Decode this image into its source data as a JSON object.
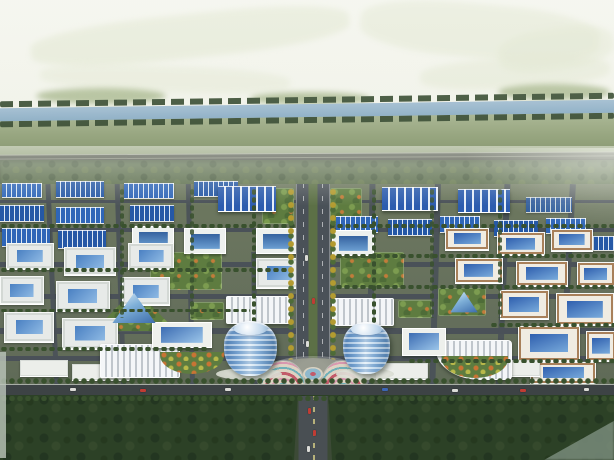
{
  "scene": {
    "type": "aerial-architectural-rendering",
    "subject": "bird's-eye rendering of an industrial park: river and fields behind, grid of blue-roofed factories and courtyard buildings, central tree-lined boulevard with twin cylindrical glass towers and a circular flower plaza, dark forest belt in front"
  },
  "palette": {
    "sky_top": "#f4f5ee",
    "sky_bottom": "#e8ecdc",
    "distant_field": "#dfe5cd",
    "mound": "#9cae7e",
    "river": "#a3bed1",
    "river_tree": "#43563c",
    "field_top": "#aab794",
    "field_bottom": "#84946c",
    "highway": "#42473d",
    "highway_line": "#767b6c",
    "treeline": "#5c6e4e",
    "treeline_dark": "#4a5c40",
    "park": "#68725e",
    "road": "#4a5158",
    "road_main": "#3d4345",
    "roof_a": "#2f66b8",
    "roof_b": "#2558a6",
    "big_roof": "#2c5cae",
    "rib": "#dce8f4",
    "wall": "#edf0ee",
    "court_blue_1": "#4a80c2",
    "court_blue_2": "#8fbae4",
    "tan": "#a8805a",
    "tan_wall": "#f0ece2",
    "lawn": "#5e7c40",
    "lawn_light": "#7c9c50",
    "tree_dark": "#39512e",
    "tree_mid": "#4e6c38",
    "tree_yellow": "#b39b30",
    "tower_2": "#d8e9f5",
    "tower_3": "#4d7cb0",
    "plaza": "#8e9188",
    "fan_base": "#ddd2c2",
    "flower_red": "#c25a6a",
    "flower_teal": "#6fb0b8",
    "flower_pink": "#d898b0",
    "forest": "#2c4126",
    "forest_dark": "#233621",
    "forest_light": "#7a8c7c",
    "car_red": "#c03c34",
    "car_white": "#dcdcd8",
    "car_blue": "#3c66b4"
  },
  "scene_items": {
    "distant_fields": [
      {
        "x": 30,
        "y": 14,
        "w": 320,
        "h": 44,
        "r": -6,
        "o": 0.55
      },
      {
        "x": 360,
        "y": 4,
        "w": 240,
        "h": 54,
        "r": 5,
        "o": 0.5
      },
      {
        "x": 420,
        "y": 58,
        "w": 190,
        "h": 30,
        "r": -3,
        "o": 0.45
      },
      {
        "x": 40,
        "y": 66,
        "w": 250,
        "h": 26,
        "r": 2,
        "o": 0.4
      },
      {
        "x": 498,
        "y": 28,
        "w": 116,
        "h": 42,
        "r": -8,
        "o": 0.45
      }
    ],
    "mounds": [
      {
        "x": 36,
        "y": 88,
        "w": 130,
        "h": 16
      },
      {
        "x": 250,
        "y": 92,
        "w": 120,
        "h": 13
      },
      {
        "x": 498,
        "y": 84,
        "w": 112,
        "h": 16
      }
    ],
    "fields": [
      {
        "x": 0,
        "y": 112,
        "w": 614,
        "h": 48
      }
    ],
    "river_trees": [
      {
        "x": 0,
        "y": 97,
        "w": 614,
        "h": 6,
        "r": -0.8
      },
      {
        "x": 0,
        "y": 117,
        "w": 614,
        "h": 6,
        "r": -0.8
      }
    ],
    "rivers": [
      {
        "x": -8,
        "y": 104,
        "w": 630,
        "h": 13,
        "r": -0.8
      }
    ],
    "highways": [
      {
        "x": 0,
        "y": 154,
        "w": 614,
        "h": 7,
        "r": -0.3
      }
    ],
    "treelines": [
      {
        "x": 0,
        "y": 160,
        "w": 614,
        "h": 26
      }
    ],
    "parks": [
      {
        "x": 0,
        "y": 184,
        "w": 614,
        "h": 212
      }
    ],
    "h_roads": [
      {
        "x": 0,
        "y": 200,
        "w": 614,
        "h": 3
      },
      {
        "x": 0,
        "y": 228,
        "w": 614,
        "h": 4
      },
      {
        "x": 0,
        "y": 262,
        "w": 614,
        "h": 5
      },
      {
        "x": 0,
        "y": 294,
        "w": 614,
        "h": 5
      },
      {
        "x": 0,
        "y": 328,
        "w": 614,
        "h": 6
      },
      {
        "x": 0,
        "y": 356,
        "w": 614,
        "h": 5
      }
    ],
    "v_roads": [
      {
        "x": 50,
        "y": 184,
        "w": 5,
        "h": 210,
        "r": -2.5
      },
      {
        "x": 118,
        "y": 184,
        "w": 5,
        "h": 210,
        "r": -1.8
      },
      {
        "x": 188,
        "y": 184,
        "w": 5,
        "h": 210,
        "r": -1.2
      },
      {
        "x": 252,
        "y": 252,
        "w": 5,
        "h": 144,
        "r": -0.6
      },
      {
        "x": 368,
        "y": 184,
        "w": 6,
        "h": 212,
        "r": 0.8
      },
      {
        "x": 432,
        "y": 184,
        "w": 6,
        "h": 212,
        "r": 1.6
      },
      {
        "x": 500,
        "y": 184,
        "w": 6,
        "h": 212,
        "r": 2.4
      },
      {
        "x": 564,
        "y": 184,
        "w": 6,
        "h": 212,
        "r": 3.2
      }
    ],
    "plots": [
      {
        "x": 150,
        "y": 252,
        "w": 72,
        "h": 38
      },
      {
        "x": 340,
        "y": 252,
        "w": 64,
        "h": 36
      },
      {
        "x": 262,
        "y": 188,
        "w": 32,
        "h": 36
      },
      {
        "x": 330,
        "y": 188,
        "w": 32,
        "h": 36
      },
      {
        "x": 190,
        "y": 302,
        "w": 34,
        "h": 18
      },
      {
        "x": 398,
        "y": 300,
        "w": 34,
        "h": 18
      },
      {
        "x": 438,
        "y": 288,
        "w": 48,
        "h": 28
      }
    ],
    "tri_plots": [
      {
        "x": 92,
        "y": 288,
        "w": 86,
        "h": 44
      }
    ],
    "factories": [
      {
        "x": 2,
        "y": 183,
        "w": 40,
        "h": 13
      },
      {
        "x": 56,
        "y": 181,
        "w": 48,
        "h": 15,
        "v": "b"
      },
      {
        "x": 124,
        "y": 183,
        "w": 50,
        "h": 14
      },
      {
        "x": 194,
        "y": 181,
        "w": 44,
        "h": 14,
        "v": "b"
      },
      {
        "x": 0,
        "y": 205,
        "w": 44,
        "h": 15,
        "v": "b"
      },
      {
        "x": 56,
        "y": 207,
        "w": 48,
        "h": 15
      },
      {
        "x": 130,
        "y": 205,
        "w": 44,
        "h": 15,
        "v": "b"
      },
      {
        "x": 2,
        "y": 228,
        "w": 48,
        "h": 17
      },
      {
        "x": 58,
        "y": 230,
        "w": 48,
        "h": 17,
        "v": "b"
      },
      {
        "x": 218,
        "y": 186,
        "w": 58,
        "h": 24,
        "v": "big"
      },
      {
        "x": 382,
        "y": 187,
        "w": 56,
        "h": 22,
        "v": "big"
      },
      {
        "x": 458,
        "y": 189,
        "w": 52,
        "h": 22,
        "v": "big"
      },
      {
        "x": 526,
        "y": 197,
        "w": 46,
        "h": 14,
        "v": "b",
        "o": 0.85
      },
      {
        "x": 336,
        "y": 216,
        "w": 42,
        "h": 15
      },
      {
        "x": 388,
        "y": 219,
        "w": 44,
        "h": 15,
        "v": "b"
      },
      {
        "x": 440,
        "y": 216,
        "w": 40,
        "h": 15
      },
      {
        "x": 494,
        "y": 220,
        "w": 44,
        "h": 15,
        "v": "b"
      },
      {
        "x": 546,
        "y": 218,
        "w": 40,
        "h": 14
      },
      {
        "x": 584,
        "y": 236,
        "w": 30,
        "h": 13,
        "v": "b"
      },
      {
        "x": 132,
        "y": 226,
        "w": 40,
        "h": 24,
        "v": "frame"
      },
      {
        "x": 184,
        "y": 228,
        "w": 40,
        "h": 24,
        "v": "frame"
      },
      {
        "x": 256,
        "y": 228,
        "w": 40,
        "h": 24,
        "v": "frame"
      },
      {
        "x": 332,
        "y": 230,
        "w": 40,
        "h": 24,
        "v": "frame"
      }
    ],
    "white_courtyards": [
      {
        "x": 6,
        "y": 243,
        "w": 46,
        "h": 24
      },
      {
        "x": 64,
        "y": 247,
        "w": 50,
        "h": 26
      },
      {
        "x": 128,
        "y": 243,
        "w": 44,
        "h": 24
      },
      {
        "x": 0,
        "y": 276,
        "w": 42,
        "h": 26
      },
      {
        "x": 56,
        "y": 281,
        "w": 52,
        "h": 28
      },
      {
        "x": 122,
        "y": 277,
        "w": 46,
        "h": 26
      },
      {
        "x": 4,
        "y": 312,
        "w": 48,
        "h": 28
      },
      {
        "x": 62,
        "y": 318,
        "w": 54,
        "h": 29
      },
      {
        "x": 256,
        "y": 258,
        "w": 44,
        "h": 28
      }
    ],
    "tan_courtyards": [
      {
        "x": 445,
        "y": 228,
        "w": 42,
        "h": 20
      },
      {
        "x": 497,
        "y": 232,
        "w": 46,
        "h": 21
      },
      {
        "x": 551,
        "y": 229,
        "w": 40,
        "h": 20
      },
      {
        "x": 455,
        "y": 258,
        "w": 46,
        "h": 23
      },
      {
        "x": 516,
        "y": 261,
        "w": 50,
        "h": 23
      },
      {
        "x": 577,
        "y": 262,
        "w": 36,
        "h": 22
      },
      {
        "x": 500,
        "y": 290,
        "w": 47,
        "h": 27
      },
      {
        "x": 556,
        "y": 293,
        "w": 56,
        "h": 30
      },
      {
        "x": 518,
        "y": 326,
        "w": 60,
        "h": 33
      },
      {
        "x": 586,
        "y": 331,
        "w": 28,
        "h": 28
      },
      {
        "x": 530,
        "y": 362,
        "w": 64,
        "h": 20
      }
    ],
    "long_buildings": [
      {
        "x": 20,
        "y": 360,
        "w": 48,
        "h": 16
      },
      {
        "x": 72,
        "y": 364,
        "w": 58,
        "h": 16
      },
      {
        "x": 376,
        "y": 363,
        "w": 52,
        "h": 16
      },
      {
        "x": 494,
        "y": 360,
        "w": 46,
        "h": 16
      }
    ],
    "ribbed_buildings": [
      {
        "x": 226,
        "y": 296,
        "w": 62,
        "h": 26
      },
      {
        "x": 332,
        "y": 298,
        "w": 60,
        "h": 26
      },
      {
        "x": 100,
        "y": 344,
        "w": 78,
        "h": 32
      },
      {
        "x": 436,
        "y": 340,
        "w": 74,
        "h": 38,
        "v": "curved"
      }
    ],
    "atriums": [
      {
        "x": 152,
        "y": 322,
        "w": 58,
        "h": 24
      },
      {
        "x": 402,
        "y": 328,
        "w": 42,
        "h": 26
      }
    ],
    "pyramids": [
      {
        "x": 112,
        "y": 292,
        "w": 44,
        "h": 32
      },
      {
        "x": 450,
        "y": 291,
        "w": 28,
        "h": 22
      }
    ],
    "crescents": [
      {
        "x": 160,
        "y": 352,
        "w": 64,
        "h": 22
      },
      {
        "x": 442,
        "y": 356,
        "w": 66,
        "h": 22
      }
    ],
    "tree_rows": [
      {
        "x": 0,
        "y": 224,
        "w": 614,
        "h": 4
      },
      {
        "x": 0,
        "y": 268,
        "w": 292,
        "h": 4
      },
      {
        "x": 335,
        "y": 254,
        "w": 279,
        "h": 4
      },
      {
        "x": 0,
        "y": 309,
        "w": 250,
        "h": 3
      },
      {
        "x": 335,
        "y": 285,
        "w": 279,
        "h": 4
      },
      {
        "x": 0,
        "y": 347,
        "w": 208,
        "h": 4
      },
      {
        "x": 490,
        "y": 323,
        "w": 124,
        "h": 4
      },
      {
        "x": 408,
        "y": 359,
        "w": 206,
        "h": 4
      },
      {
        "x": 252,
        "y": 188,
        "w": 4,
        "h": 164,
        "v": "vert"
      },
      {
        "x": 372,
        "y": 188,
        "w": 4,
        "h": 164,
        "v": "vert"
      },
      {
        "x": 120,
        "y": 188,
        "w": 4,
        "h": 130,
        "v": "vert",
        "o": 0.85
      },
      {
        "x": 190,
        "y": 188,
        "w": 4,
        "h": 130,
        "v": "vert",
        "o": 0.85
      },
      {
        "x": 430,
        "y": 188,
        "w": 4,
        "h": 130,
        "v": "vert",
        "o": 0.85
      },
      {
        "x": 498,
        "y": 188,
        "w": 4,
        "h": 130,
        "v": "vert",
        "o": 0.85
      }
    ],
    "boulevards": [
      {
        "x": 296,
        "y": 184,
        "w": 32,
        "h": 212
      }
    ],
    "yellow_tree_cols": [
      {
        "x": 288,
        "y": 188,
        "w": 6,
        "h": 172,
        "v": "yellow"
      },
      {
        "x": 330,
        "y": 188,
        "w": 6,
        "h": 172,
        "v": "yellow"
      }
    ],
    "blvd_cars": [
      {
        "x": 305,
        "y": 255,
        "w": 3,
        "h": 6,
        "c": "car_white"
      },
      {
        "x": 312,
        "y": 298,
        "w": 3,
        "h": 6,
        "c": "car_red"
      },
      {
        "x": 306,
        "y": 341,
        "w": 3,
        "h": 6,
        "c": "car_white"
      }
    ],
    "plazas": [
      {
        "x": 258,
        "y": 358,
        "w": 110,
        "h": 40
      }
    ],
    "fans": [
      {
        "x": 262,
        "y": 361,
        "w": 42,
        "h": 26
      },
      {
        "x": 322,
        "y": 361,
        "w": 42,
        "h": 26
      }
    ],
    "fountains": [
      {
        "x": 303,
        "y": 367,
        "w": 20,
        "h": 14
      }
    ],
    "podiums": [
      {
        "x": 216,
        "y": 368,
        "w": 66,
        "h": 12
      },
      {
        "x": 336,
        "y": 368,
        "w": 58,
        "h": 12
      }
    ],
    "towers": [
      {
        "x": 224,
        "y": 321,
        "w": 53,
        "h": 55
      },
      {
        "x": 343,
        "y": 322,
        "w": 47,
        "h": 52
      }
    ],
    "road_mains": [
      {
        "x": 0,
        "y": 384,
        "w": 614,
        "h": 12
      }
    ],
    "main_cars": [
      {
        "x": 70,
        "y": 388,
        "w": 6,
        "h": 3,
        "c": "car_white"
      },
      {
        "x": 140,
        "y": 389,
        "w": 6,
        "h": 3,
        "c": "car_red"
      },
      {
        "x": 225,
        "y": 388,
        "w": 6,
        "h": 3,
        "c": "car_white"
      },
      {
        "x": 382,
        "y": 388,
        "w": 6,
        "h": 3,
        "c": "car_blue"
      },
      {
        "x": 452,
        "y": 389,
        "w": 6,
        "h": 3,
        "c": "car_white"
      },
      {
        "x": 520,
        "y": 389,
        "w": 6,
        "h": 3,
        "c": "car_red"
      },
      {
        "x": 584,
        "y": 388,
        "w": 5,
        "h": 3,
        "c": "car_white"
      }
    ],
    "forests": [
      {
        "x": 0,
        "y": 395,
        "w": 614,
        "h": 65
      }
    ],
    "forest_roads": [
      {
        "x": 294,
        "y": 396,
        "w": 38,
        "h": 64
      }
    ],
    "forest_cars": [
      {
        "x": 308,
        "y": 408,
        "w": 3,
        "h": 6,
        "c": "car_red"
      },
      {
        "x": 313,
        "y": 430,
        "w": 3,
        "h": 6,
        "c": "car_red"
      },
      {
        "x": 307,
        "y": 446,
        "w": 3,
        "h": 6,
        "c": "car_white"
      }
    ],
    "roadside_trees": [
      {
        "x": 0,
        "y": 378,
        "w": 614,
        "h": 6
      },
      {
        "x": 0,
        "y": 396,
        "w": 614,
        "h": 5
      }
    ],
    "light_patches": [
      {
        "x": 544,
        "y": 414,
        "w": 70,
        "h": 46
      }
    ],
    "light_strips": [
      {
        "x": 0,
        "y": 352,
        "w": 6,
        "h": 106
      }
    ],
    "hazes": [
      {
        "x": 0,
        "y": 146,
        "w": 614,
        "h": 60,
        "v": "h1"
      },
      {
        "x": 462,
        "y": 148,
        "w": 152,
        "h": 84,
        "v": "h2"
      },
      {
        "x": 0,
        "y": 0,
        "w": 614,
        "h": 134,
        "v": "h3"
      }
    ]
  }
}
